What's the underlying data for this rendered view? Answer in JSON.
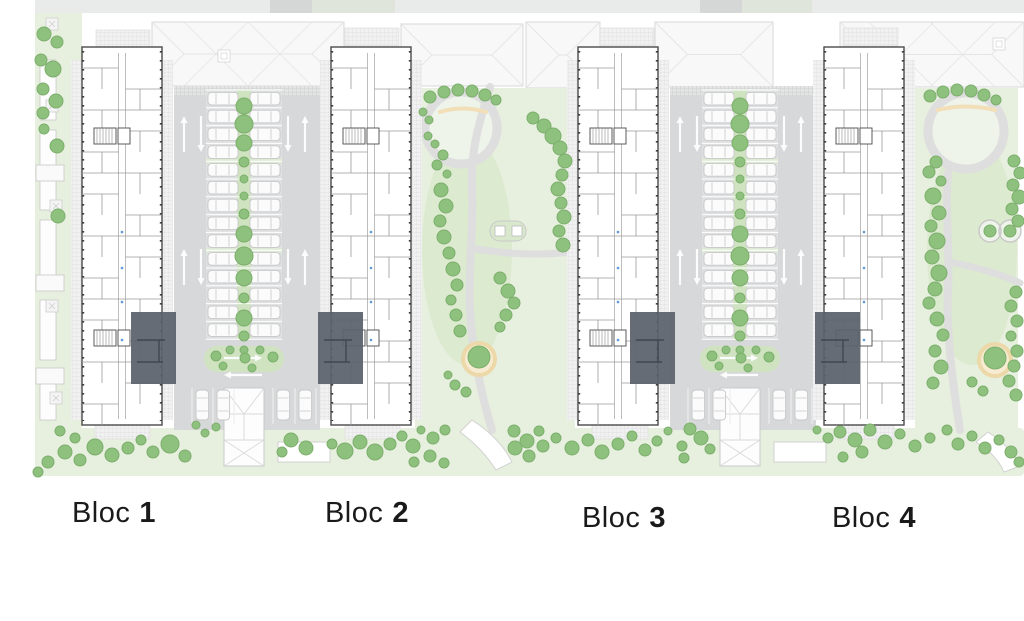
{
  "plan": {
    "width": 1024,
    "height": 621,
    "blocks": [
      {
        "id": 1,
        "label_word": "Bloc",
        "label_number": "1",
        "x": 82,
        "label_cx": 114,
        "label_top": 497,
        "highlight_x": 131,
        "highlight_side": "right"
      },
      {
        "id": 2,
        "label_word": "Bloc",
        "label_number": "2",
        "x": 331,
        "label_cx": 367,
        "label_top": 497,
        "highlight_x": 318,
        "highlight_side": "left"
      },
      {
        "id": 3,
        "label_word": "Bloc",
        "label_number": "3",
        "x": 578,
        "label_cx": 624,
        "label_top": 502,
        "highlight_x": 630,
        "highlight_side": "right"
      },
      {
        "id": 4,
        "label_word": "Bloc",
        "label_number": "4",
        "x": 824,
        "label_cx": 874,
        "label_top": 502,
        "highlight_x": 815,
        "highlight_side": "left"
      }
    ],
    "building": {
      "y": 47,
      "w": 80,
      "h": 378
    },
    "highlight": {
      "y": 312,
      "w": 45,
      "h": 72
    },
    "parking_courts": [
      {
        "x": 174,
        "w": 146,
        "cx": 244
      },
      {
        "x": 670,
        "w": 146,
        "cx": 740
      }
    ],
    "parking": {
      "top": 86,
      "bottom": 430,
      "stall_top": 90,
      "rows": 14,
      "pitch": 17.8,
      "car_len": 30,
      "car_wid": 12.6,
      "median_half": 7,
      "ramp": {
        "dy": 388,
        "w": 40,
        "h": 78
      }
    },
    "roofs": [
      {
        "x": 152,
        "y": 22,
        "w": 192,
        "h": 64,
        "vent": [
          218,
          50
        ]
      },
      {
        "x": 401,
        "y": 24,
        "w": 122,
        "h": 62,
        "vent": null
      },
      {
        "x": 526,
        "y": 22,
        "w": 74,
        "h": 66,
        "vent": null
      },
      {
        "x": 655,
        "y": 22,
        "w": 118,
        "h": 65,
        "vent": null
      },
      {
        "x": 840,
        "y": 22,
        "w": 184,
        "h": 65,
        "vent": [
          993,
          38
        ]
      }
    ],
    "road": {
      "y": 0,
      "h": 13,
      "x": 35,
      "dark_segments": [
        [
          270,
          42
        ],
        [
          700,
          42
        ]
      ],
      "green_segments": [
        [
          312,
          83
        ],
        [
          742,
          70
        ]
      ]
    },
    "left_strip": {
      "x": 35,
      "w": 47,
      "y": 13,
      "h": 457
    },
    "bottom_strip": {
      "x": 35,
      "y": 428,
      "w": 989,
      "h": 48
    },
    "courtyards": [
      {
        "x": 415,
        "w": 160,
        "ring_cx": 461,
        "ring_cy": 128,
        "ring_r": 36,
        "bench": "M 440 112 Q 462 105 486 112",
        "path1": "M 490 87 C 480 120 470 150 472 190 C 474 230 468 270 470 310 C 472 350 480 390 492 430",
        "path2": "M 470 248 C 500 253 540 257 575 251",
        "sand": [
          479,
          359
        ],
        "play": {
          "type": "squares",
          "cx": 508,
          "cy": 231
        }
      },
      {
        "x": 915,
        "w": 103,
        "ring_cx": 966,
        "ring_cy": 131,
        "ring_r": 38,
        "bench": "M 938 110 Q 965 103 995 110",
        "path1": "M 948 172 C 945 210 950 250 948 290 C 946 330 952 380 960 430",
        "path2": "M 950 262 C 980 268 1005 276 1020 283",
        "sand": [
          995,
          360
        ],
        "play": {
          "type": "circles",
          "cx": 1000,
          "cy": 231
        }
      }
    ],
    "entry_hatches_top": [
      [
        96,
        30,
        54,
        17
      ],
      [
        345,
        28,
        54,
        18
      ],
      [
        600,
        28,
        54,
        18
      ],
      [
        843,
        28,
        55,
        18
      ]
    ],
    "entry_hatches_bottom": [
      [
        95,
        425,
        55,
        14
      ],
      [
        345,
        425,
        55,
        14
      ],
      [
        592,
        425,
        56,
        14
      ],
      [
        838,
        425,
        56,
        14
      ]
    ],
    "side_pads": [
      [
        278,
        442,
        52,
        20
      ],
      [
        774,
        442,
        52,
        20
      ]
    ],
    "stairs_features": [
      "M 472 420 Q 500 438 512 462 L 496 470 Q 482 448 460 432 Z",
      "M 988 432 Q 1010 446 1020 466 L 1004 472 Q 996 454 976 442 Z"
    ],
    "left_structures": [
      [
        40,
        60,
        16,
        60
      ],
      [
        40,
        130,
        16,
        80
      ],
      [
        40,
        220,
        16,
        70
      ],
      [
        40,
        300,
        16,
        60
      ],
      [
        40,
        370,
        16,
        50
      ]
    ],
    "left_pads": [
      [
        36,
        165,
        28,
        16
      ],
      [
        36,
        275,
        28,
        16
      ],
      [
        36,
        368,
        28,
        16
      ]
    ],
    "left_squares": [
      [
        46,
        18
      ],
      [
        46,
        100
      ],
      [
        50,
        200
      ],
      [
        46,
        300
      ],
      [
        50,
        392
      ]
    ]
  },
  "landscape": {
    "median_trees_y": [
      106,
      124,
      143,
      162,
      179,
      196,
      214,
      234,
      256,
      278,
      298,
      318,
      336,
      350
    ],
    "median_trees_r": [
      8,
      9,
      8,
      5,
      4,
      4,
      5,
      8,
      9,
      8,
      5,
      8,
      5,
      4
    ],
    "island_trees": [
      [
        -30,
        356,
        5
      ],
      [
        -16,
        350,
        4
      ],
      [
        -1,
        358,
        5
      ],
      [
        14,
        350,
        4
      ],
      [
        27,
        357,
        5
      ],
      [
        -23,
        366,
        4
      ],
      [
        6,
        368,
        4
      ]
    ],
    "trees": [
      [
        44,
        34,
        7
      ],
      [
        57,
        42,
        6
      ],
      [
        41,
        60,
        6
      ],
      [
        53,
        69,
        8
      ],
      [
        43,
        89,
        6
      ],
      [
        56,
        101,
        7
      ],
      [
        43,
        113,
        6
      ],
      [
        44,
        129,
        5
      ],
      [
        57,
        146,
        7
      ],
      [
        58,
        216,
        7
      ],
      [
        430,
        97,
        6
      ],
      [
        444,
        92,
        6
      ],
      [
        458,
        90,
        6
      ],
      [
        472,
        91,
        6
      ],
      [
        485,
        95,
        6
      ],
      [
        496,
        100,
        5
      ],
      [
        533,
        118,
        6
      ],
      [
        544,
        126,
        7
      ],
      [
        553,
        136,
        8
      ],
      [
        560,
        148,
        7
      ],
      [
        565,
        161,
        7
      ],
      [
        562,
        175,
        6
      ],
      [
        558,
        189,
        7
      ],
      [
        561,
        203,
        6
      ],
      [
        564,
        217,
        7
      ],
      [
        559,
        231,
        6
      ],
      [
        563,
        245,
        7
      ],
      [
        423,
        112,
        4
      ],
      [
        429,
        120,
        4
      ],
      [
        428,
        136,
        4
      ],
      [
        435,
        144,
        4
      ],
      [
        443,
        155,
        5
      ],
      [
        437,
        165,
        5
      ],
      [
        447,
        174,
        4
      ],
      [
        441,
        190,
        7
      ],
      [
        446,
        206,
        7
      ],
      [
        440,
        221,
        6
      ],
      [
        444,
        237,
        7
      ],
      [
        449,
        253,
        6
      ],
      [
        453,
        269,
        7
      ],
      [
        457,
        285,
        6
      ],
      [
        451,
        300,
        5
      ],
      [
        456,
        315,
        6
      ],
      [
        460,
        331,
        6
      ],
      [
        500,
        278,
        6
      ],
      [
        508,
        291,
        7
      ],
      [
        514,
        303,
        6
      ],
      [
        506,
        315,
        6
      ],
      [
        500,
        327,
        5
      ],
      [
        479,
        357,
        11
      ],
      [
        455,
        385,
        5
      ],
      [
        466,
        392,
        5
      ],
      [
        448,
        375,
        4
      ],
      [
        930,
        96,
        6
      ],
      [
        943,
        92,
        6
      ],
      [
        957,
        90,
        6
      ],
      [
        971,
        91,
        6
      ],
      [
        984,
        95,
        6
      ],
      [
        996,
        100,
        5
      ],
      [
        936,
        162,
        6
      ],
      [
        929,
        172,
        6
      ],
      [
        941,
        181,
        5
      ],
      [
        933,
        196,
        8
      ],
      [
        939,
        213,
        7
      ],
      [
        931,
        226,
        6
      ],
      [
        937,
        241,
        8
      ],
      [
        932,
        257,
        7
      ],
      [
        939,
        273,
        8
      ],
      [
        935,
        289,
        7
      ],
      [
        929,
        303,
        6
      ],
      [
        937,
        319,
        7
      ],
      [
        943,
        335,
        6
      ],
      [
        935,
        351,
        6
      ],
      [
        941,
        367,
        7
      ],
      [
        933,
        383,
        6
      ],
      [
        1014,
        161,
        6
      ],
      [
        1020,
        173,
        6
      ],
      [
        1013,
        185,
        6
      ],
      [
        1019,
        197,
        7
      ],
      [
        1012,
        209,
        6
      ],
      [
        1018,
        221,
        6
      ],
      [
        1016,
        292,
        6
      ],
      [
        1011,
        306,
        6
      ],
      [
        1017,
        321,
        6
      ],
      [
        1011,
        336,
        5
      ],
      [
        1017,
        351,
        6
      ],
      [
        1014,
        366,
        6
      ],
      [
        1009,
        381,
        6
      ],
      [
        1016,
        395,
        6
      ],
      [
        995,
        358,
        11
      ],
      [
        972,
        382,
        5
      ],
      [
        983,
        391,
        5
      ],
      [
        38,
        472,
        5
      ],
      [
        48,
        462,
        6
      ],
      [
        65,
        452,
        7
      ],
      [
        80,
        460,
        6
      ],
      [
        60,
        431,
        5
      ],
      [
        75,
        438,
        5
      ],
      [
        95,
        447,
        8
      ],
      [
        112,
        455,
        7
      ],
      [
        128,
        448,
        6
      ],
      [
        141,
        440,
        5
      ],
      [
        153,
        452,
        6
      ],
      [
        170,
        444,
        9
      ],
      [
        185,
        456,
        6
      ],
      [
        196,
        425,
        4
      ],
      [
        205,
        433,
        4
      ],
      [
        216,
        427,
        4
      ],
      [
        282,
        452,
        5
      ],
      [
        291,
        440,
        7
      ],
      [
        306,
        448,
        7
      ],
      [
        332,
        444,
        5
      ],
      [
        345,
        451,
        8
      ],
      [
        360,
        442,
        7
      ],
      [
        375,
        452,
        8
      ],
      [
        390,
        444,
        6
      ],
      [
        402,
        436,
        5
      ],
      [
        413,
        446,
        7
      ],
      [
        421,
        430,
        4
      ],
      [
        433,
        438,
        6
      ],
      [
        445,
        430,
        5
      ],
      [
        430,
        456,
        6
      ],
      [
        444,
        463,
        5
      ],
      [
        414,
        462,
        5
      ],
      [
        514,
        431,
        6
      ],
      [
        527,
        441,
        7
      ],
      [
        539,
        431,
        5
      ],
      [
        515,
        448,
        7
      ],
      [
        529,
        456,
        6
      ],
      [
        543,
        446,
        6
      ],
      [
        556,
        438,
        5
      ],
      [
        572,
        448,
        7
      ],
      [
        588,
        440,
        6
      ],
      [
        602,
        452,
        7
      ],
      [
        618,
        444,
        6
      ],
      [
        632,
        436,
        5
      ],
      [
        645,
        450,
        6
      ],
      [
        657,
        441,
        5
      ],
      [
        668,
        431,
        4
      ],
      [
        682,
        446,
        5
      ],
      [
        690,
        429,
        6
      ],
      [
        701,
        438,
        7
      ],
      [
        710,
        449,
        5
      ],
      [
        684,
        458,
        5
      ],
      [
        817,
        430,
        4
      ],
      [
        828,
        438,
        5
      ],
      [
        840,
        432,
        6
      ],
      [
        855,
        440,
        7
      ],
      [
        870,
        430,
        6
      ],
      [
        885,
        442,
        7
      ],
      [
        900,
        434,
        5
      ],
      [
        915,
        446,
        6
      ],
      [
        930,
        438,
        5
      ],
      [
        947,
        430,
        5
      ],
      [
        958,
        444,
        6
      ],
      [
        972,
        436,
        5
      ],
      [
        985,
        448,
        6
      ],
      [
        999,
        440,
        5
      ],
      [
        1011,
        452,
        6
      ],
      [
        1019,
        462,
        5
      ],
      [
        862,
        452,
        6
      ],
      [
        843,
        457,
        5
      ]
    ]
  },
  "colors": {
    "road": "#e9eaea",
    "road_dark": "#d5d7d7",
    "road_green": "#dfe5da",
    "green_light": "#e7f0df",
    "green_mid": "#d9e8cc",
    "green_pale": "#eef4ea",
    "tree": "#8ec17e",
    "tree_edge": "#7cae6c",
    "asphalt": "#d6d8d9",
    "stall_zone": "#dddfe0",
    "median": "#cfe3c0",
    "band": "#dfead6",
    "roof": "#f7f8f7",
    "roof_line": "#e5e5e5",
    "roof_edge": "#d8d8d8",
    "wall": "#4a4a4a",
    "room": "#9b9b9b",
    "tick": "#3f3f3f",
    "highlight": "#5b636d",
    "highlight_line": "#40474f",
    "path": "#dedede",
    "sand": "#f7ecd2",
    "sand_ring": "#ecd8a9",
    "bench": "#f2dfb8",
    "car": "#fbfbfb",
    "car_edge": "#c7c7c7",
    "white": "#ffffff",
    "label": "#1a1a1a",
    "blue_mark": "#5b9bd5",
    "pad_edge": "#d0d0d0"
  }
}
